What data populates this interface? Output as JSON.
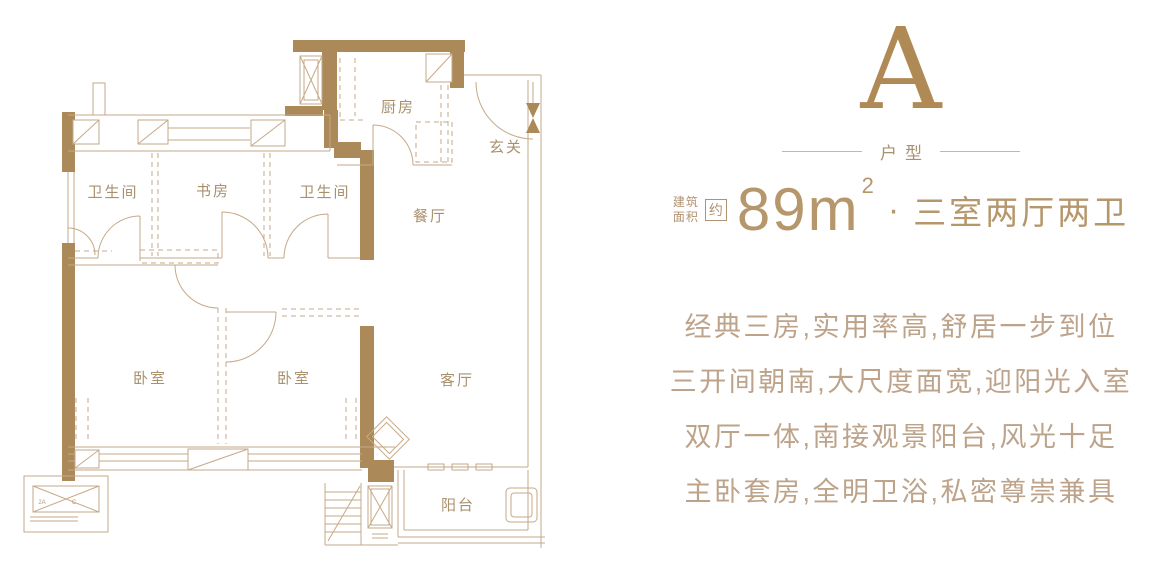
{
  "floor_plan": {
    "rooms": [
      {
        "id": "bathroom-left",
        "label": "卫生间"
      },
      {
        "id": "study",
        "label": "书房"
      },
      {
        "id": "bathroom-right",
        "label": "卫生间"
      },
      {
        "id": "kitchen",
        "label": "厨房"
      },
      {
        "id": "foyer",
        "label": "玄关"
      },
      {
        "id": "dining",
        "label": "餐厅"
      },
      {
        "id": "bedroom-left",
        "label": "卧室"
      },
      {
        "id": "bedroom-right",
        "label": "卧室"
      },
      {
        "id": "living",
        "label": "客厅"
      },
      {
        "id": "balcony",
        "label": "阳台"
      }
    ],
    "bay_window_marks": {
      "left": "2A",
      "right": "C"
    }
  },
  "info_panel": {
    "type_letter": "A",
    "type_label": "户型",
    "area_prefix_line1": "建筑",
    "area_prefix_line2": "面积",
    "area_approx": "约",
    "area_number": "89m",
    "area_power": "2",
    "separator": "·",
    "layout_text": "三室两厅两卫",
    "description_lines": [
      "经典三房,实用率高,舒居一步到位",
      "三开间朝南,大尺度面宽,迎阳光入室",
      "双厅一体,南接观景阳台,风光十足",
      "主卧套房,全明卫浴,私密尊崇兼具"
    ]
  },
  "colors": {
    "accent_gold": "#b08a55",
    "wall_brown": "#ac8959",
    "thin_line": "#c6a988",
    "number_tan": "#b6976c",
    "description_tan": "#bda38a"
  }
}
